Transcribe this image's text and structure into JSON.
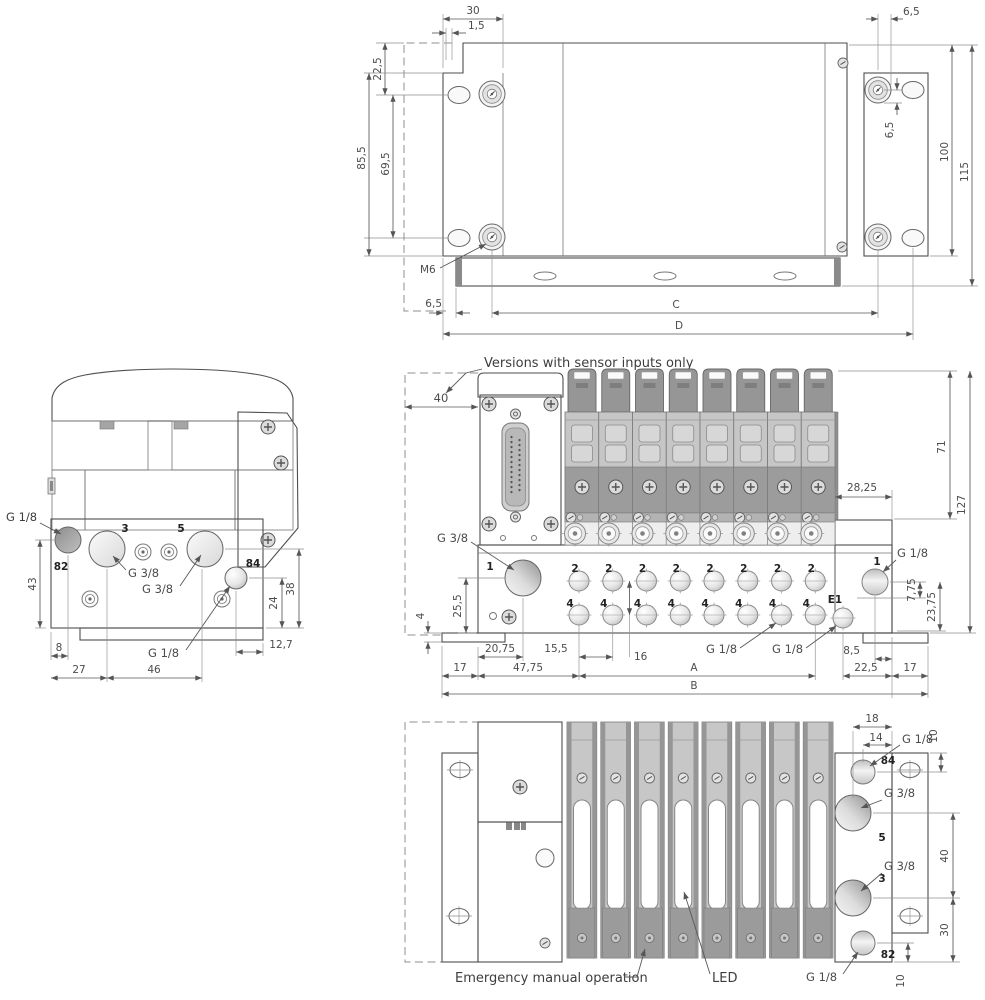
{
  "rear": {
    "d30": "30",
    "d1_5": "1,5",
    "d22_5": "22,5",
    "d85_5": "85,5",
    "d69_5": "69,5",
    "d6_5_top": "6,5",
    "d6_5_hole": "6,5",
    "d100": "100",
    "d115": "115",
    "m6": "M6",
    "d6_5_rail": "6,5",
    "c": "C",
    "d": "D"
  },
  "side": {
    "g18_82": "G 1/8",
    "p82": "82",
    "p3": "3",
    "p5": "5",
    "g38_3": "G 3/8",
    "g38_5": "G 3/8",
    "p84": "84",
    "g18_84": "G 1/8",
    "d43": "43",
    "d8": "8",
    "d27": "27",
    "d46": "46",
    "d24": "24",
    "d38": "38",
    "d12_7": "12,7"
  },
  "front": {
    "note": "Versions with sensor inputs only",
    "d40": "40",
    "g38_1": "G 3/8",
    "p1": "1",
    "d25_5": "25,5",
    "d4": "4",
    "d20_75": "20,75",
    "d15_5": "15,5",
    "d16": "16",
    "d17_left": "17",
    "d47_75": "47,75",
    "a": "A",
    "b": "B",
    "g18_4": "G 1/8",
    "g18_e1": "G 1/8",
    "e1": "E1",
    "d8_5": "8,5",
    "d22_5": "22,5",
    "d17_right": "17",
    "d28_25": "28,25",
    "d71": "71",
    "d127": "127",
    "d7_75": "7,75",
    "d23_75": "23,75",
    "p1_right": "1",
    "g18_1": "G 1/8",
    "p2": "2",
    "p4": "4"
  },
  "bottom": {
    "d18": "18",
    "d14": "14",
    "g18_84": "G 1/8",
    "d10_top": "10",
    "p84": "84",
    "g38_5": "G 3/8",
    "p5": "5",
    "d40": "40",
    "g38_3": "G 3/8",
    "p3": "3",
    "d30": "30",
    "p82": "82",
    "d10_bottom": "10",
    "g18_82": "G 1/8",
    "emergency": "Emergency manual operation",
    "led": "LED"
  }
}
